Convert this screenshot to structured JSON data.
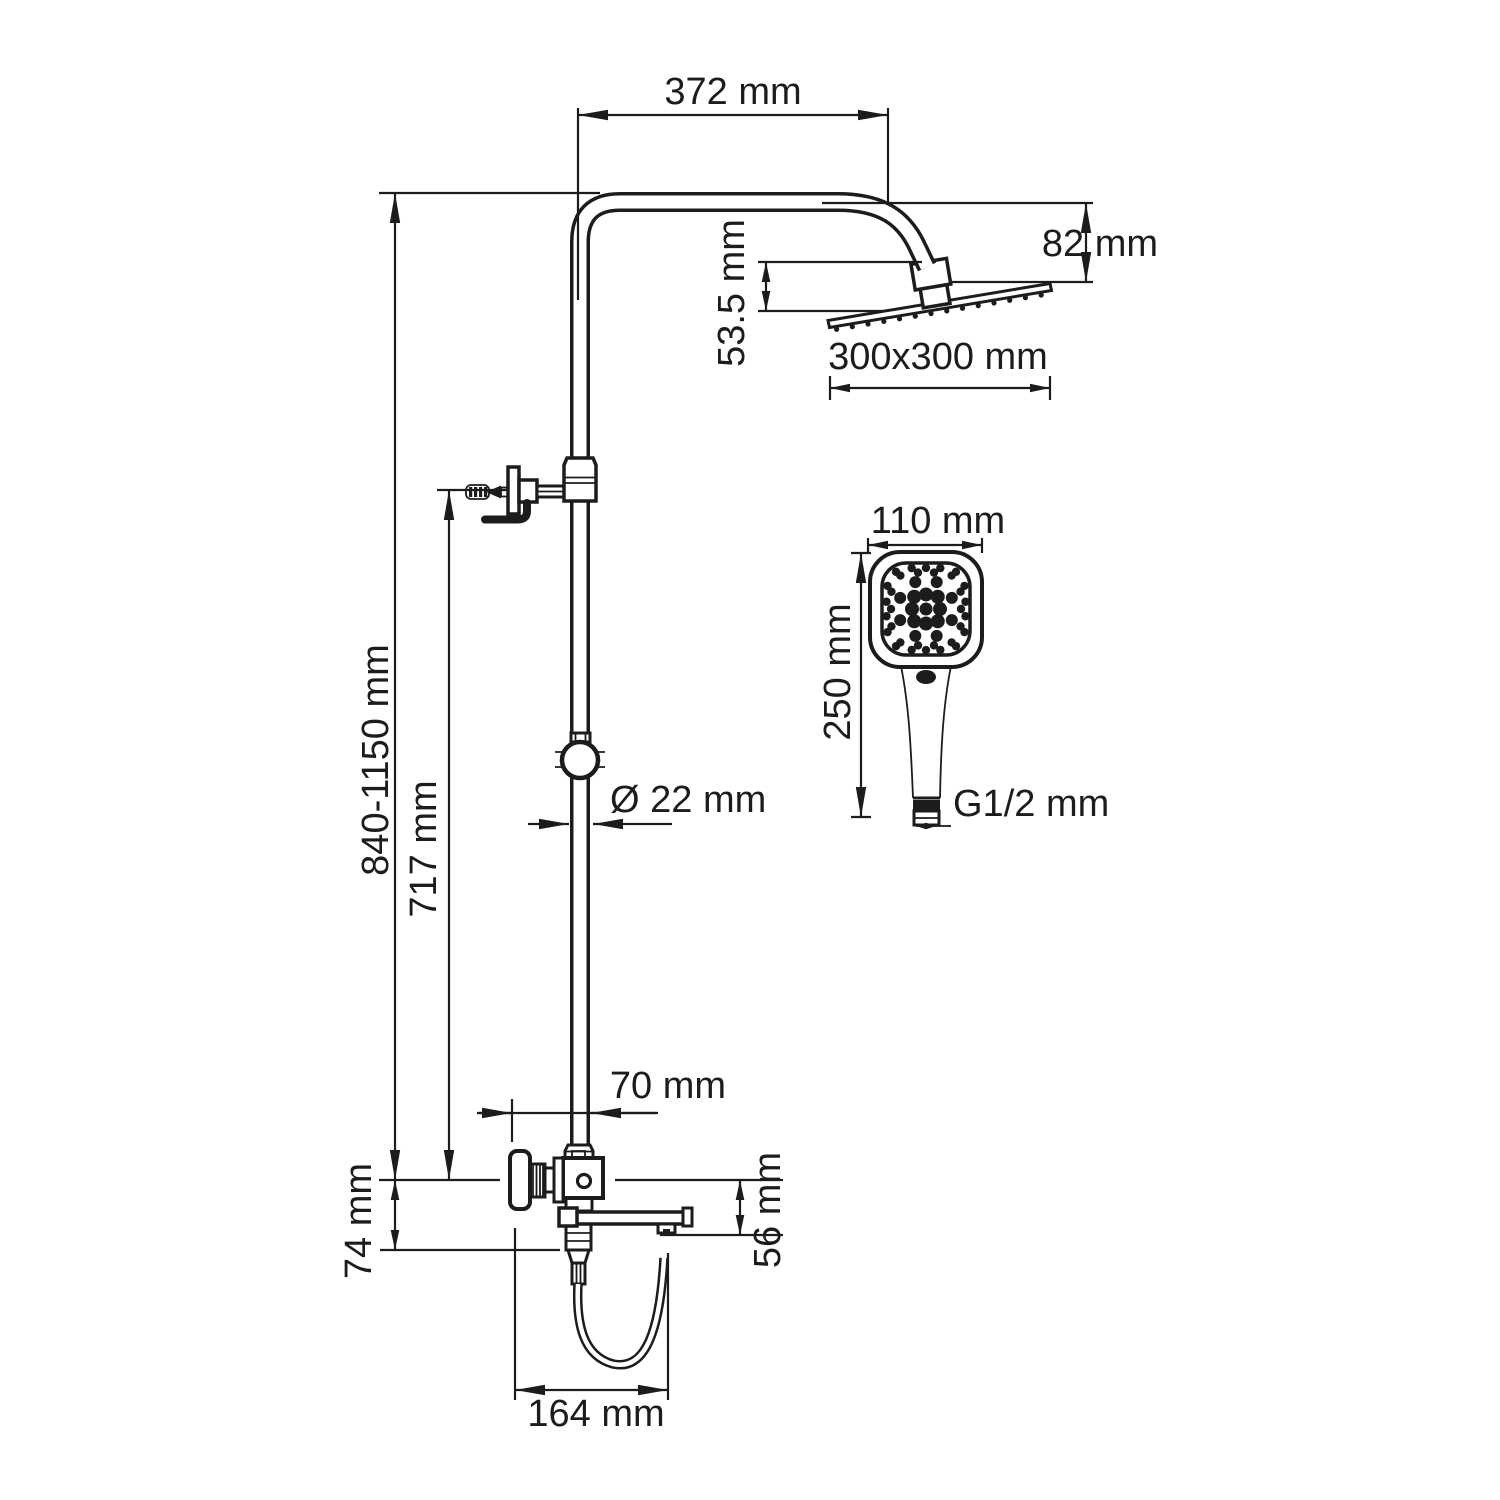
{
  "meta": {
    "background": "#ffffff",
    "ink": "#1c1c1c"
  },
  "dimensions": {
    "arm_reach": "372 mm",
    "head_height": "82 mm",
    "head_offset": "53.5 mm",
    "head_size": "300x300 mm",
    "column_height": "840-1150 mm",
    "bracket_height": "717 mm",
    "pipe_diameter": "Ø 22 mm",
    "hand_shower_width": "110 mm",
    "hand_shower_length": "250 mm",
    "hand_shower_thread": "G1/2 mm",
    "spout_offset": "70 mm",
    "valve_drop": "74 mm",
    "spout_drop": "56 mm",
    "spout_length": "164 mm"
  }
}
